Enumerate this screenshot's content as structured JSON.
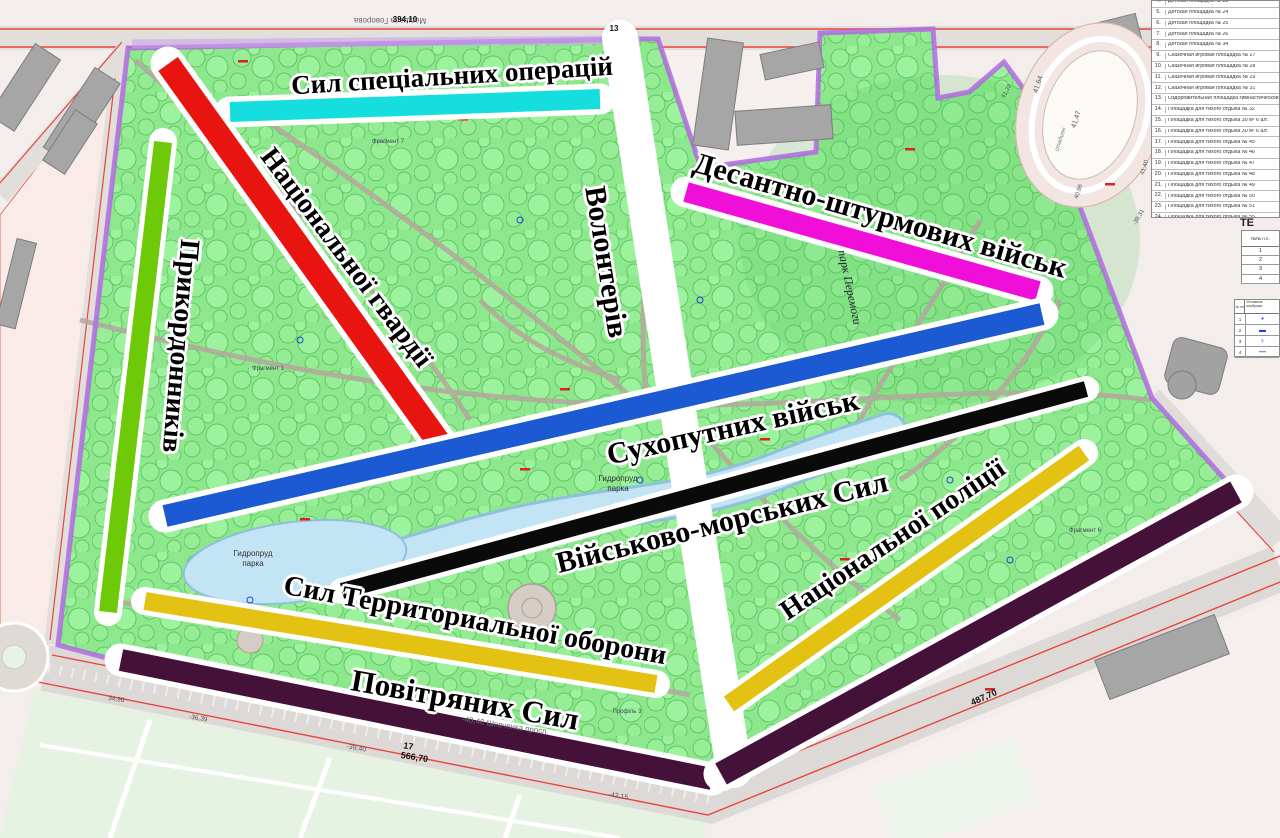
{
  "alleys": [
    {
      "name": "special-operations-forces",
      "label": "Сил спеціальних операцій",
      "color": "#17dede"
    },
    {
      "name": "national-guard",
      "label": "Національної гвардії",
      "color": "#e71410"
    },
    {
      "name": "border-guards",
      "label": "Прикордонників",
      "color": "#6ec908"
    },
    {
      "name": "volunteers",
      "label": "Волонтерів",
      "color": "#ffffff"
    },
    {
      "name": "air-assault-forces",
      "label": "Десантно-штурмових військ",
      "color": "#ef0fd8"
    },
    {
      "name": "ground-forces",
      "label": "Сухопутних військ",
      "color": "#1b5ad2"
    },
    {
      "name": "navy",
      "label": "Військово-морських Сил",
      "color": "#0a0a0a"
    },
    {
      "name": "territorial-defense",
      "label": "Сил Территориальної оборони",
      "color": "#e4c213"
    },
    {
      "name": "air-forces",
      "label": "Повітряних Сил",
      "color": "#441238"
    },
    {
      "name": "national-police",
      "label": "Національної поліції",
      "color": "#e4c213"
    }
  ],
  "map": {
    "pond_line1": "Гидропруд",
    "pond_line2": "парка",
    "park_name": "парк Перемоги",
    "street_top": "Маршала Говорова",
    "street_bottom": "-40,40 Шевченка просп.",
    "fragments": {
      "f7": "Фрагмент 7",
      "f1": "Фрагмент 1",
      "f6": "Фрагмент 6",
      "p3": "Профіль 3"
    },
    "numbers": {
      "top": "394,10",
      "thirteen": "13",
      "seventeen": "17",
      "bottomlen": "566,70",
      "n3940": "-39,40",
      "n4215": "-42,15",
      "n3639": "-36,39",
      "n3490": "34,90",
      "n48770": "487,70",
      "s4164": "41,64",
      "s4147": "41,47",
      "s4173": "41,73",
      "s4140": "41,40",
      "s4096": "40,96",
      "s3931": "-39,31",
      "stadium": "стадион"
    }
  },
  "legend": {
    "items": [
      {
        "num": "4.",
        "text": "Детская площадка № 23"
      },
      {
        "num": "5.",
        "text": "Детская площадка № 24"
      },
      {
        "num": "6.",
        "text": "Детская площадка № 25"
      },
      {
        "num": "7.",
        "text": "Детская площадка № 26"
      },
      {
        "num": "8.",
        "text": "Детская площадка № 34"
      },
      {
        "num": "9.",
        "text": "Сказочная игровая площадка № 27"
      },
      {
        "num": "10.",
        "text": "Сказочная игровая площадка № 28"
      },
      {
        "num": "11.",
        "text": "Сказочная игровая площадка № 29"
      },
      {
        "num": "12.",
        "text": "Сказочная игровая площадка № 31"
      },
      {
        "num": "13.",
        "text": "Оздоровительная площадка гимнастической п."
      },
      {
        "num": "14.",
        "text": "Площадка для тихого отдыха № 32"
      },
      {
        "num": "15.",
        "text": "Площадка для тихого отдыха 30 м² 6 шт."
      },
      {
        "num": "16.",
        "text": "Площадка для тихого отдыха 30 м² 6 шт."
      },
      {
        "num": "17.",
        "text": "Площадка для тихого отдыха № 45"
      },
      {
        "num": "18.",
        "text": "Площадка для тихого отдыха № 46"
      },
      {
        "num": "19.",
        "text": "Площадка для тихого отдыха № 47"
      },
      {
        "num": "20.",
        "text": "Площадка для тихого отдыха № 48"
      },
      {
        "num": "21.",
        "text": "Площадка для тихого отдыха № 49"
      },
      {
        "num": "22.",
        "text": "Площадка для тихого отдыха № 50"
      },
      {
        "num": "23.",
        "text": "Площадка для тихого отдыха № 51"
      },
      {
        "num": "24.",
        "text": "Площадка для тихого отдыха № 55"
      },
      {
        "num": "25.",
        "text": "Площадка для тихого отдыха № 102"
      }
    ]
  },
  "tables": {
    "te": "ТЕ",
    "t1": {
      "header": "№№ п.п.",
      "rows": [
        "1",
        "2",
        "3",
        "4"
      ]
    },
    "t2": {
      "head1": "№ пп",
      "head2": "Условные изображе",
      "rows": [
        {
          "num": "1",
          "glyph": "•"
        },
        {
          "num": "2",
          "glyph": "▬"
        },
        {
          "num": "3",
          "glyph": "♀"
        },
        {
          "num": "4",
          "glyph": "—"
        }
      ]
    }
  }
}
